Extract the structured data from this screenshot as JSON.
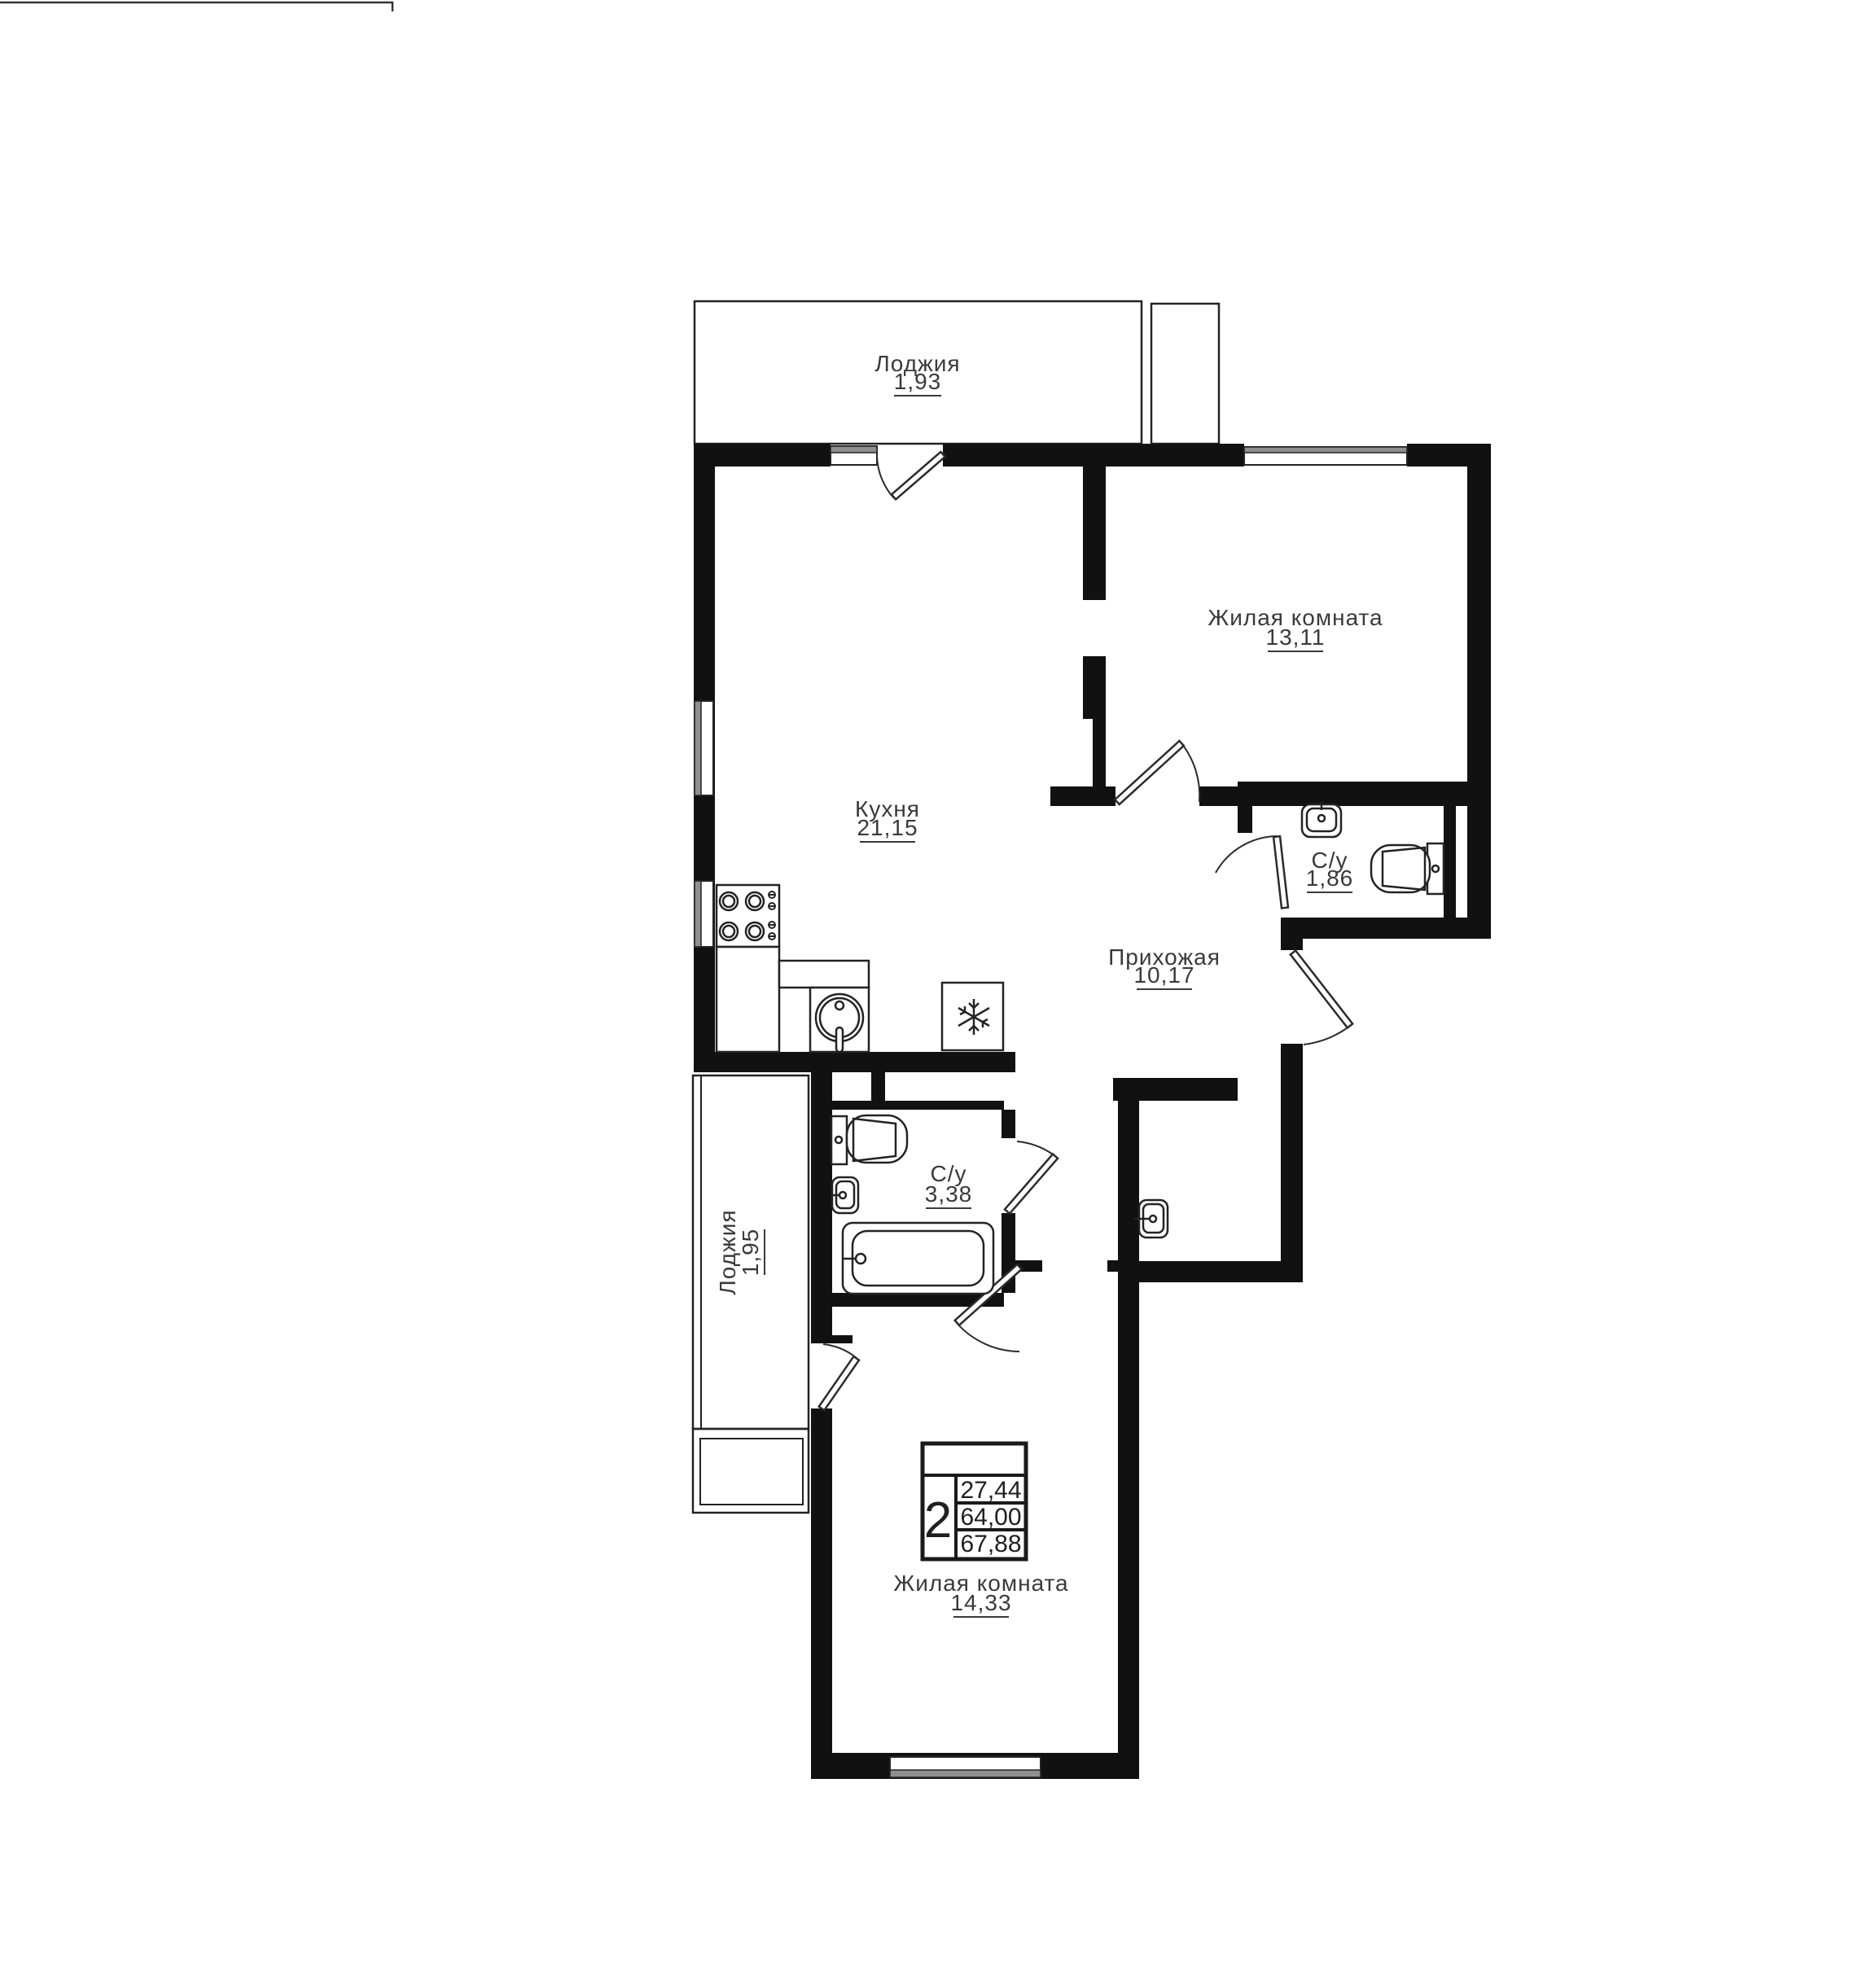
{
  "plan": {
    "type": "apartment-floor-plan",
    "colors": {
      "wall": "#111111",
      "line": "#232323",
      "glass": "#8f8f8f",
      "text": "#3a3a3a"
    }
  },
  "rooms": [
    {
      "id": "loggia-top",
      "name": "Лоджия",
      "area": "1,93"
    },
    {
      "id": "living-room-top",
      "name": "Жилая комната",
      "area": "13,11"
    },
    {
      "id": "kitchen",
      "name": "Кухня",
      "area": "21,15"
    },
    {
      "id": "bathroom-small",
      "name": "С/у",
      "area": "1,86"
    },
    {
      "id": "hallway",
      "name": "Прихожая",
      "area": "10,17"
    },
    {
      "id": "bathroom-large",
      "name": "С/у",
      "area": "3,38"
    },
    {
      "id": "loggia-left",
      "name": "Лоджия",
      "area": "1,95"
    },
    {
      "id": "living-room-bottom",
      "name": "Жилая комната",
      "area": "14,33"
    }
  ],
  "summary": {
    "rooms_count": "2",
    "areas": [
      "27,44",
      "64,00",
      "67,88"
    ]
  }
}
